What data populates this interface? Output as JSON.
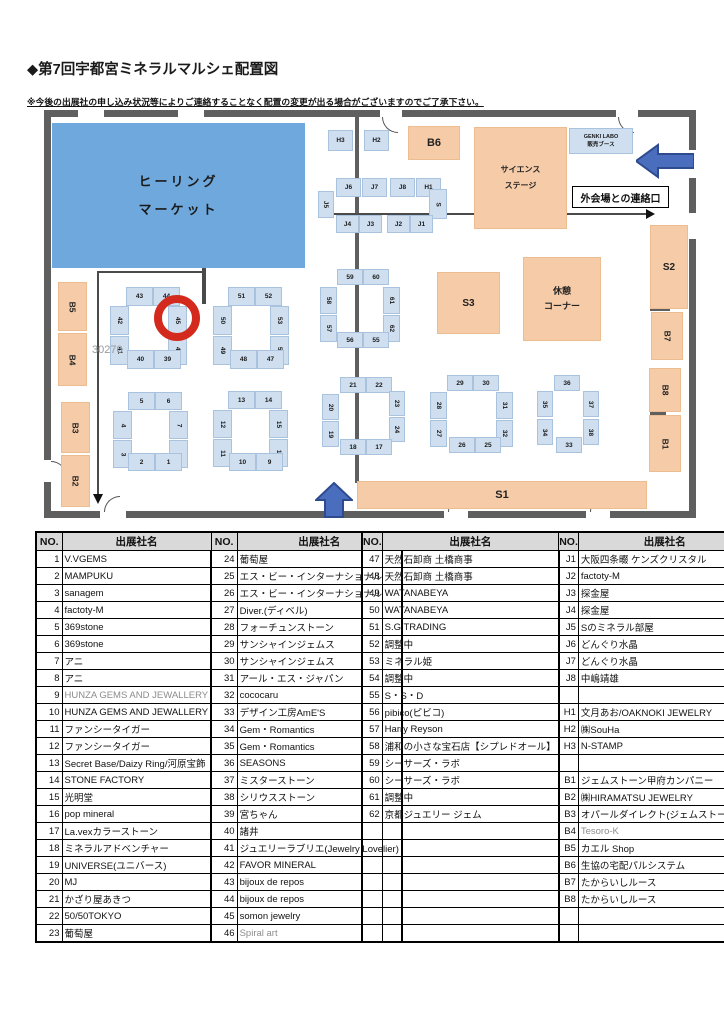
{
  "page": {
    "title": "◆第7回宇都宮ミネラルマルシェ配置図",
    "note": "※今後の出展社の申し込み状況等によりご連絡することなく配置の変更が出る場合がございますのでご了承下さい。"
  },
  "map": {
    "exit_label": "外会場との連絡口",
    "watermark": "30270",
    "blues": [
      {
        "l": "ヒーリング\nマーケット",
        "x": 52,
        "y": 123,
        "w": 253,
        "h": 145,
        "fs": 13,
        "ls": 3,
        "lh": 2.1,
        "n": "healing-market-zone"
      },
      {
        "l": "GENKI LABO\n販売ブース",
        "x": 569,
        "y": 128,
        "w": 64,
        "h": 26,
        "fs": 5.5,
        "lh": 1.5,
        "light": 1,
        "n": "genki-labo-booth"
      }
    ],
    "areas": [
      {
        "l": "B6",
        "x": 408,
        "y": 126,
        "w": 52,
        "h": 34,
        "fs": 11
      },
      {
        "l": "サイエンス\nステージ",
        "x": 474,
        "y": 127,
        "w": 93,
        "h": 102,
        "fs": 8,
        "lh": 2,
        "n": "science-stage"
      },
      {
        "l": "S3",
        "x": 437,
        "y": 272,
        "w": 63,
        "h": 62,
        "fs": 10
      },
      {
        "l": "休憩\nコーナー",
        "x": 523,
        "y": 257,
        "w": 78,
        "h": 84,
        "fs": 9,
        "lh": 1.7,
        "n": "rest-corner"
      },
      {
        "l": "S2",
        "x": 650,
        "y": 225,
        "w": 38,
        "h": 84,
        "fs": 10
      },
      {
        "l": "B7",
        "x": 651,
        "y": 312,
        "w": 32,
        "h": 48,
        "r": 1,
        "fs": 8.5
      },
      {
        "l": "B8",
        "x": 649,
        "y": 368,
        "w": 32,
        "h": 44,
        "r": 1,
        "fs": 8.5
      },
      {
        "l": "B1",
        "x": 649,
        "y": 415,
        "w": 32,
        "h": 57,
        "r": 1,
        "fs": 8.5
      },
      {
        "l": "B5",
        "x": 58,
        "y": 282,
        "w": 29,
        "h": 49,
        "r": 1,
        "fs": 8.5
      },
      {
        "l": "B4",
        "x": 58,
        "y": 333,
        "w": 29,
        "h": 53,
        "r": 1,
        "fs": 8.5
      },
      {
        "l": "B3",
        "x": 61,
        "y": 402,
        "w": 29,
        "h": 51,
        "r": 1,
        "fs": 8.5
      },
      {
        "l": "B2",
        "x": 61,
        "y": 455,
        "w": 29,
        "h": 52,
        "r": 1,
        "fs": 8.5
      },
      {
        "l": "S1",
        "x": 357,
        "y": 481,
        "w": 290,
        "h": 28,
        "fs": 11
      }
    ],
    "stalls": [
      [
        "H3",
        328,
        130,
        25,
        21,
        0
      ],
      [
        "H2",
        364,
        130,
        25,
        21,
        0
      ],
      [
        "J6",
        336,
        178,
        25,
        19,
        0
      ],
      [
        "J7",
        362,
        178,
        25,
        19,
        0
      ],
      [
        "J8",
        390,
        178,
        25,
        19,
        0
      ],
      [
        "H1",
        416,
        178,
        25,
        19,
        0
      ],
      [
        "J5",
        318,
        191,
        16,
        27,
        1
      ],
      [
        "S",
        429,
        189,
        18,
        30,
        1
      ],
      [
        "J4",
        336,
        215,
        23,
        18,
        0
      ],
      [
        "J3",
        359,
        215,
        23,
        18,
        0
      ],
      [
        "J2",
        387,
        215,
        23,
        18,
        0
      ],
      [
        "J1",
        410,
        215,
        23,
        18,
        0
      ],
      [
        "43",
        126,
        287,
        27,
        19,
        0
      ],
      [
        "44",
        153,
        287,
        27,
        19,
        0
      ],
      [
        "42",
        110,
        306,
        19,
        29,
        1
      ],
      [
        "41",
        110,
        336,
        19,
        29,
        1
      ],
      [
        "45",
        168,
        306,
        19,
        29,
        1
      ],
      [
        "46",
        168,
        336,
        19,
        29,
        1
      ],
      [
        "40",
        127,
        350,
        27,
        19,
        0
      ],
      [
        "39",
        154,
        350,
        27,
        19,
        0
      ],
      [
        "51",
        228,
        287,
        27,
        19,
        0
      ],
      [
        "52",
        255,
        287,
        27,
        19,
        0
      ],
      [
        "50",
        213,
        306,
        19,
        29,
        1
      ],
      [
        "49",
        213,
        336,
        19,
        29,
        1
      ],
      [
        "53",
        270,
        306,
        19,
        29,
        1
      ],
      [
        "54",
        270,
        336,
        19,
        29,
        1
      ],
      [
        "48",
        230,
        350,
        27,
        19,
        0
      ],
      [
        "47",
        257,
        350,
        27,
        19,
        0
      ],
      [
        "59",
        337,
        269,
        26,
        16,
        0
      ],
      [
        "60",
        363,
        269,
        26,
        16,
        0
      ],
      [
        "58",
        320,
        287,
        17,
        27,
        1
      ],
      [
        "57",
        320,
        315,
        17,
        27,
        1
      ],
      [
        "61",
        383,
        287,
        17,
        27,
        1
      ],
      [
        "62",
        383,
        315,
        17,
        27,
        1
      ],
      [
        "56",
        337,
        332,
        26,
        16,
        0
      ],
      [
        "55",
        363,
        332,
        26,
        16,
        0
      ],
      [
        "21",
        340,
        377,
        26,
        16,
        0
      ],
      [
        "22",
        366,
        377,
        26,
        16,
        0
      ],
      [
        "20",
        322,
        394,
        17,
        26,
        1
      ],
      [
        "19",
        322,
        421,
        17,
        26,
        1
      ],
      [
        "23",
        389,
        391,
        16,
        25,
        1
      ],
      [
        "24",
        389,
        417,
        16,
        25,
        1
      ],
      [
        "18",
        340,
        439,
        26,
        16,
        0
      ],
      [
        "17",
        366,
        439,
        26,
        16,
        0
      ],
      [
        "5",
        128,
        392,
        27,
        18,
        0
      ],
      [
        "6",
        155,
        392,
        27,
        18,
        0
      ],
      [
        "4",
        113,
        411,
        19,
        28,
        1
      ],
      [
        "3",
        113,
        440,
        19,
        28,
        1
      ],
      [
        "7",
        169,
        411,
        19,
        28,
        1
      ],
      [
        "8",
        169,
        440,
        19,
        28,
        1
      ],
      [
        "2",
        128,
        453,
        27,
        18,
        0
      ],
      [
        "1",
        155,
        453,
        27,
        18,
        0
      ],
      [
        "13",
        228,
        391,
        27,
        18,
        0
      ],
      [
        "14",
        255,
        391,
        27,
        18,
        0
      ],
      [
        "12",
        213,
        410,
        19,
        28,
        1
      ],
      [
        "11",
        213,
        439,
        19,
        28,
        1
      ],
      [
        "15",
        269,
        410,
        19,
        28,
        1
      ],
      [
        "16",
        269,
        439,
        19,
        28,
        1
      ],
      [
        "10",
        229,
        453,
        27,
        18,
        0
      ],
      [
        "9",
        256,
        453,
        27,
        18,
        0
      ],
      [
        "29",
        447,
        375,
        26,
        16,
        0
      ],
      [
        "30",
        473,
        375,
        26,
        16,
        0
      ],
      [
        "28",
        430,
        392,
        17,
        27,
        1
      ],
      [
        "27",
        430,
        420,
        17,
        27,
        1
      ],
      [
        "31",
        496,
        392,
        17,
        27,
        1
      ],
      [
        "32",
        496,
        420,
        17,
        27,
        1
      ],
      [
        "26",
        449,
        437,
        26,
        16,
        0
      ],
      [
        "25",
        475,
        437,
        26,
        16,
        0
      ],
      [
        "36",
        554,
        375,
        26,
        16,
        0
      ],
      [
        "35",
        537,
        391,
        16,
        26,
        1
      ],
      [
        "34",
        537,
        419,
        16,
        26,
        1
      ],
      [
        "37",
        583,
        391,
        16,
        26,
        1
      ],
      [
        "38",
        583,
        419,
        16,
        26,
        1
      ],
      [
        "33",
        556,
        437,
        26,
        16,
        0
      ]
    ]
  },
  "table": {
    "headers": [
      "NO.",
      "出展社名",
      "NO.",
      "出展社名"
    ],
    "left": [
      {
        "no1": "1",
        "name1": "V.VGEMS",
        "no2": "24",
        "name2": "葡萄屋"
      },
      {
        "no1": "2",
        "name1": "MAMPUKU",
        "no2": "25",
        "name2": "エス・ビー・インターナショナル"
      },
      {
        "no1": "3",
        "name1": "sanagem",
        "no2": "26",
        "name2": "エス・ビー・インターナショナル"
      },
      {
        "no1": "4",
        "name1": "factoty-M",
        "no2": "27",
        "name2": "Diver.(ディベル)"
      },
      {
        "no1": "5",
        "name1": "369stone",
        "no2": "28",
        "name2": "フォーチュンストーン"
      },
      {
        "no1": "6",
        "name1": "369stone",
        "no2": "29",
        "name2": "サンシャインジェムス"
      },
      {
        "no1": "7",
        "name1": "アニ",
        "no2": "30",
        "name2": "サンシャインジェムス"
      },
      {
        "no1": "8",
        "name1": "アニ",
        "no2": "31",
        "name2": "アール・エス・ジャパン"
      },
      {
        "no1": "9",
        "name1": "HUNZA GEMS AND JEWALLERY",
        "g1": true,
        "no2": "32",
        "name2": "cococaru"
      },
      {
        "no1": "10",
        "name1": "HUNZA GEMS AND JEWALLERY",
        "no2": "33",
        "name2": "デザイン工房AmE'S"
      },
      {
        "no1": "11",
        "name1": "ファンシータイガー",
        "no2": "34",
        "name2": "Gem・Romantics"
      },
      {
        "no1": "12",
        "name1": "ファンシータイガー",
        "no2": "35",
        "name2": "Gem・Romantics"
      },
      {
        "no1": "13",
        "name1": "Secret Base/Daizy Ring/河原宝飾",
        "no2": "36",
        "name2": "SEASONS"
      },
      {
        "no1": "14",
        "name1": "STONE FACTORY",
        "no2": "37",
        "name2": "ミスターストーン"
      },
      {
        "no1": "15",
        "name1": "光明堂",
        "no2": "38",
        "name2": "シリウスストーン"
      },
      {
        "no1": "16",
        "name1": "pop mineral",
        "no2": "39",
        "name2": "宮ちゃん"
      },
      {
        "no1": "17",
        "name1": "La.vexカラーストーン",
        "no2": "40",
        "name2": "諸井"
      },
      {
        "no1": "18",
        "name1": "ミネラルアドベンチャー",
        "no2": "41",
        "name2": "ジュエリーラブリエ(Jewelry Lovelier)"
      },
      {
        "no1": "19",
        "name1": "UNIVERSE(ユニバース)",
        "no2": "42",
        "name2": "FAVOR MINERAL"
      },
      {
        "no1": "20",
        "name1": "MJ",
        "no2": "43",
        "name2": "bijoux de repos"
      },
      {
        "no1": "21",
        "name1": "かざり屋あきつ",
        "no2": "44",
        "name2": "bijoux de repos"
      },
      {
        "no1": "22",
        "name1": "50/50TOKYO",
        "no2": "45",
        "name2": "somon jewelry"
      },
      {
        "no1": "23",
        "name1": "葡萄屋",
        "no2": "46",
        "name2": "Spiral art",
        "g2": true
      }
    ],
    "right": [
      {
        "no1": "47",
        "name1": "天然石卸商 土橋商事",
        "no2": "J1",
        "name2": "大阪四条畷 ケンズクリスタル"
      },
      {
        "no1": "48",
        "name1": "天然石卸商 土橋商事",
        "no2": "J2",
        "name2": "factoty-M"
      },
      {
        "no1": "49",
        "name1": "WATANABEYA",
        "no2": "J3",
        "name2": "探金屋"
      },
      {
        "no1": "50",
        "name1": "WATANABEYA",
        "no2": "J4",
        "name2": "探金屋"
      },
      {
        "no1": "51",
        "name1": "S.G TRADING",
        "no2": "J5",
        "name2": "Sのミネラル部屋"
      },
      {
        "no1": "52",
        "name1": "調整中",
        "no2": "J6",
        "name2": "どんぐり水晶"
      },
      {
        "no1": "53",
        "name1": "ミネラル姫",
        "no2": "J7",
        "name2": "どんぐり水晶"
      },
      {
        "no1": "54",
        "name1": "調整中",
        "no2": "J8",
        "name2": "中嶋靖雄"
      },
      {
        "no1": "55",
        "name1": "S・S・D",
        "no2": "",
        "name2": ""
      },
      {
        "no1": "56",
        "name1": "pibico(ピビコ)",
        "no2": "H1",
        "name2": "文月あお/OAKNOKI JEWELRY"
      },
      {
        "no1": "57",
        "name1": "Harry Reyson",
        "no2": "H2",
        "name2": "㈱SouHa"
      },
      {
        "no1": "58",
        "name1": "浦和の小さな宝石店【シプレドオール】",
        "no2": "H3",
        "name2": "N-STAMP"
      },
      {
        "no1": "59",
        "name1": "シーサーズ・ラボ",
        "no2": "",
        "name2": ""
      },
      {
        "no1": "60",
        "name1": "シーサーズ・ラボ",
        "no2": "B1",
        "name2": "ジェムストーン甲府カンパニー"
      },
      {
        "no1": "61",
        "name1": "調整中",
        "no2": "B2",
        "name2": "㈱HIRAMATSU JEWELRY"
      },
      {
        "no1": "62",
        "name1": "京都ジュエリー ジェム",
        "no2": "B3",
        "name2": "オパールダイレクト(ジェムストーリー)"
      },
      {
        "no1": "",
        "name1": "",
        "no2": "B4",
        "name2": "Tesoro-K",
        "g2": true
      },
      {
        "no1": "",
        "name1": "",
        "no2": "B5",
        "name2": "カエル Shop"
      },
      {
        "no1": "",
        "name1": "",
        "no2": "B6",
        "name2": "生協の宅配パルシステム"
      },
      {
        "no1": "",
        "name1": "",
        "no2": "B7",
        "name2": "たからいしルース"
      },
      {
        "no1": "",
        "name1": "",
        "no2": "B8",
        "name2": "たからいしルース"
      },
      {
        "no1": "",
        "name1": "",
        "no2": "",
        "name2": ""
      },
      {
        "no1": "",
        "name1": "",
        "no2": "",
        "name2": ""
      }
    ]
  }
}
